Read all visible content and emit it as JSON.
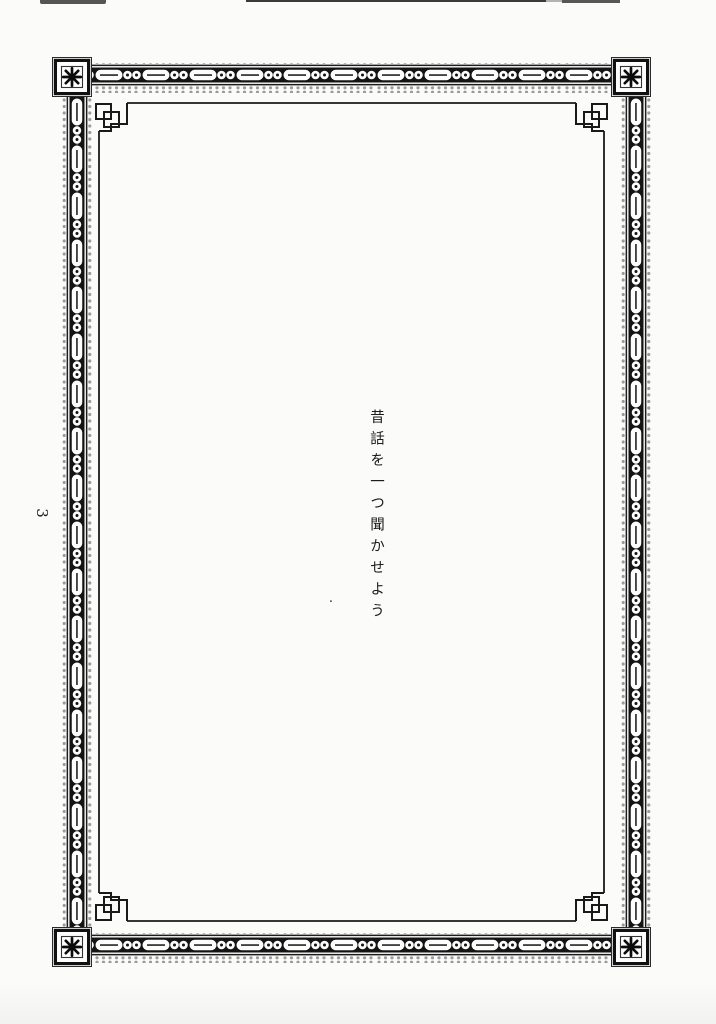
{
  "document": {
    "page_number": "3",
    "body_text": "昔話を一つ聞かせよう",
    "stray_mark": "."
  },
  "frame": {
    "corner_icon": "eight-spoke-asterisk",
    "inner_corner_icon": "interlocked-squares-fret",
    "band_motif": "oval-and-ring-chain",
    "colors": {
      "ink": "#161616",
      "paper": "#fbfbfa",
      "scallop_gray": "#9b9b9b"
    }
  }
}
